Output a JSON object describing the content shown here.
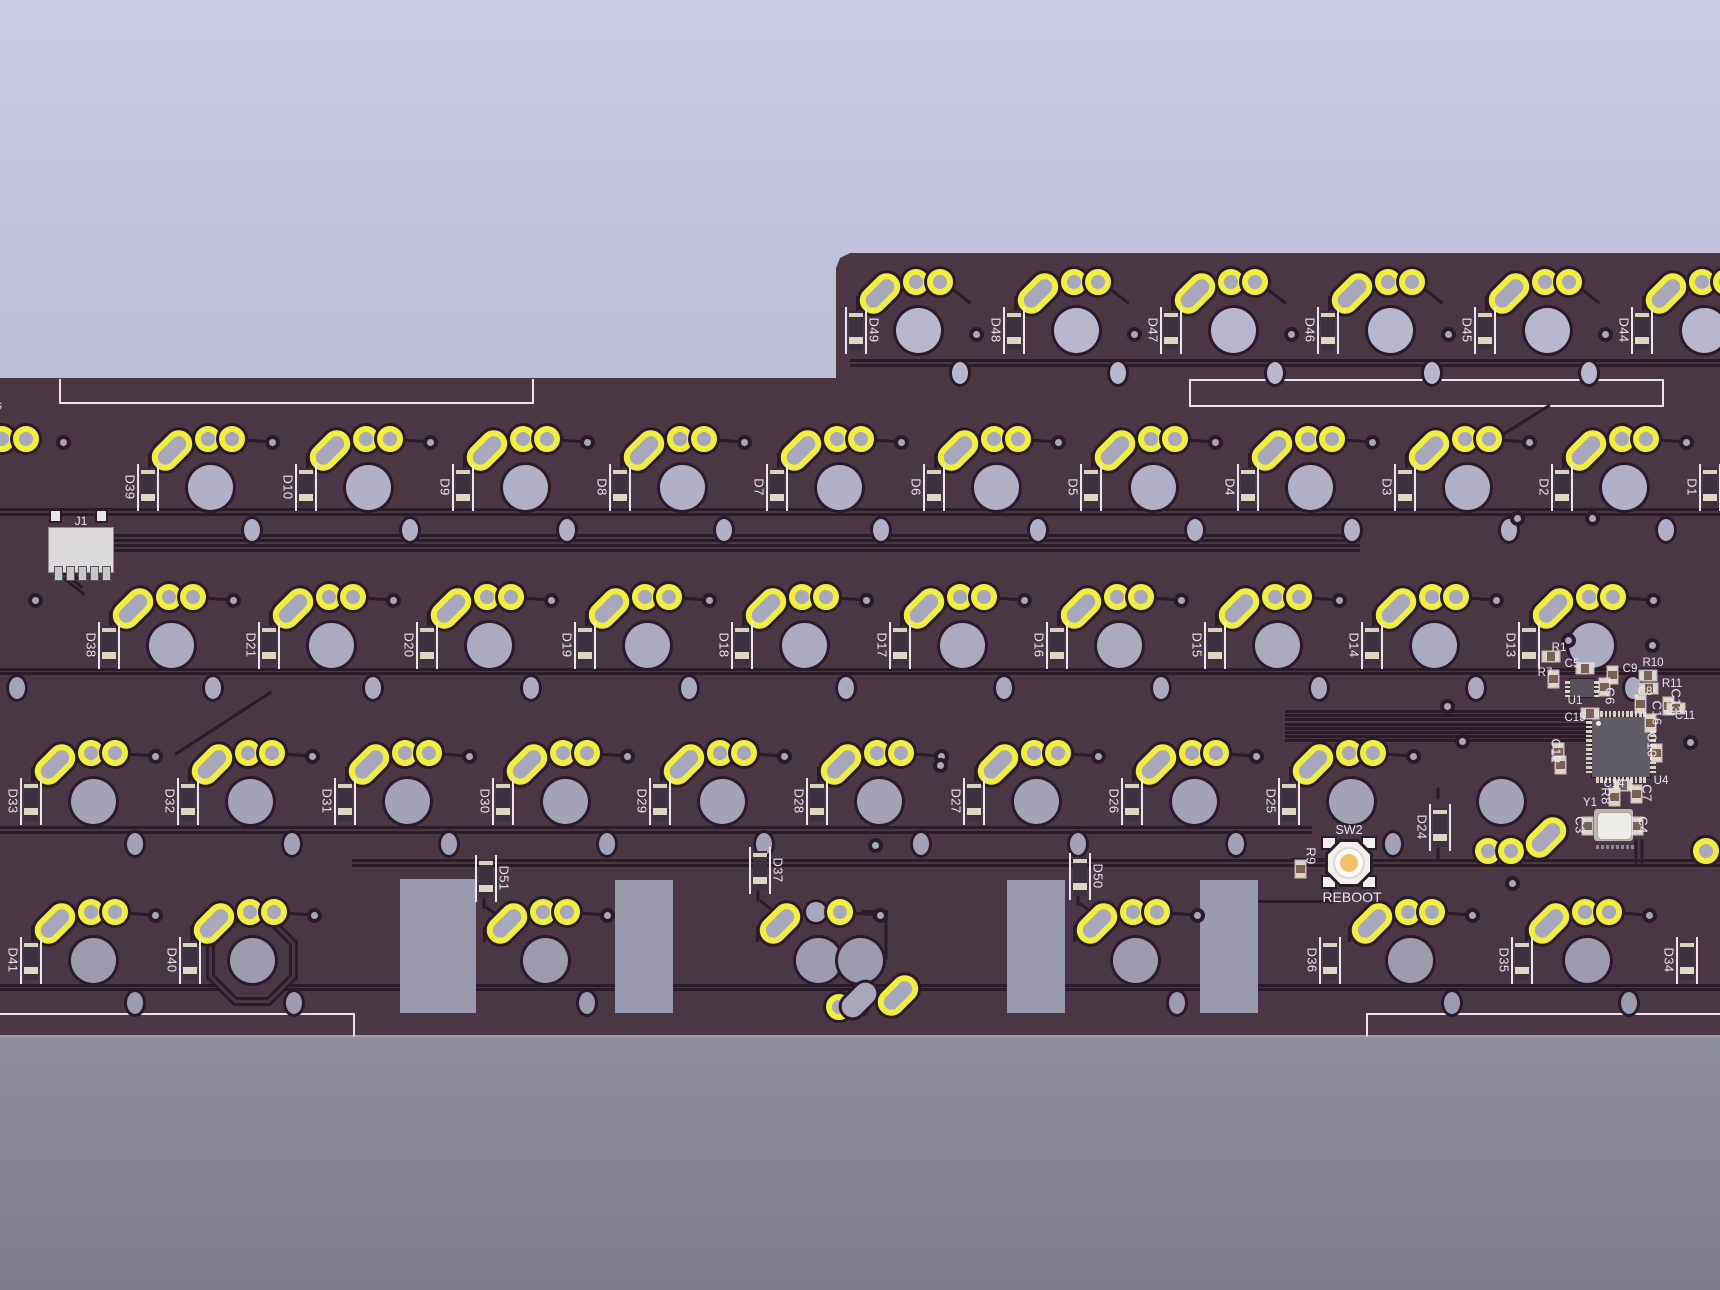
{
  "colors": {
    "board": "#4b3644",
    "trace": "#2b1b29",
    "pad_yellow": "#f2ee3f",
    "silkscreen": "#e6e4ea",
    "bg_top": "#cacae4",
    "bg_bottom": "#7e7c8a",
    "cutout": "#9a99af",
    "ic_body": "#605d66",
    "button_center": "#f1c369",
    "component_pad": "#ded7c6"
  },
  "silkscreen": {
    "left_edge_text": "s",
    "rect_left": {
      "x": 59,
      "y": 379,
      "w": 471,
      "h": 23
    },
    "rect_right": {
      "x": 1189,
      "y": 379,
      "w": 471,
      "h": 24
    },
    "bottom_left_line": {
      "x1": 0,
      "x2": 353,
      "y": 1013
    },
    "bottom_right_line": {
      "x1": 1366,
      "x2": 1720,
      "y": 1013
    }
  },
  "connector": {
    "label": "J1",
    "x": 48,
    "y": 527
  },
  "reboot": {
    "switch_label": "SW2",
    "button_label": "REBOOT",
    "x": 1349,
    "y": 862
  },
  "rows": [
    {
      "name": "row-function",
      "y": 330,
      "hole_color": "#b8b7cf",
      "via": [
        58,
        4
      ],
      "keys": [
        {
          "d": "D49",
          "x": 918,
          "side": "right"
        },
        {
          "d": "D48",
          "x": 1076
        },
        {
          "d": "D47",
          "x": 1233
        },
        {
          "d": "D46",
          "x": 1390
        },
        {
          "d": "D45",
          "x": 1547
        },
        {
          "d": "D44",
          "x": 1704
        }
      ]
    },
    {
      "name": "row-number",
      "y": 487,
      "hole_color": "#b1b0c8",
      "via": [
        62,
        -45
      ],
      "keys": [
        {
          "d": "D39",
          "x": 210
        },
        {
          "d": "D10",
          "x": 368
        },
        {
          "d": "D9",
          "x": 525
        },
        {
          "d": "D8",
          "x": 682
        },
        {
          "d": "D7",
          "x": 839
        },
        {
          "d": "D6",
          "x": 996
        },
        {
          "d": "D5",
          "x": 1153
        },
        {
          "d": "D4",
          "x": 1310
        },
        {
          "d": "D3",
          "x": 1467
        },
        {
          "d": "D2",
          "x": 1624
        }
      ]
    },
    {
      "name": "row-upper",
      "y": 645,
      "hole_color": "#abaac1",
      "via": [
        62,
        -45
      ],
      "keys": [
        {
          "d": "D38",
          "x": 171
        },
        {
          "d": "D21",
          "x": 331
        },
        {
          "d": "D20",
          "x": 489
        },
        {
          "d": "D19",
          "x": 647
        },
        {
          "d": "D18",
          "x": 804
        },
        {
          "d": "D17",
          "x": 962
        },
        {
          "d": "D16",
          "x": 1119
        },
        {
          "d": "D15",
          "x": 1277
        },
        {
          "d": "D14",
          "x": 1434
        },
        {
          "d": "D13",
          "x": 1591
        }
      ]
    },
    {
      "name": "row-home",
      "y": 801,
      "hole_color": "#a3a2b8",
      "via": [
        62,
        -45
      ],
      "keys": [
        {
          "d": "D33",
          "x": 93
        },
        {
          "d": "D32",
          "x": 250
        },
        {
          "d": "D31",
          "x": 407
        },
        {
          "d": "D30",
          "x": 565
        },
        {
          "d": "D29",
          "x": 722
        },
        {
          "d": "D28",
          "x": 879
        },
        {
          "d": "D27",
          "x": 1036
        },
        {
          "d": "D26",
          "x": 1194
        },
        {
          "d": "D25",
          "x": 1351
        },
        {
          "x": 1501,
          "no_diode": 1,
          "no_pads": 1
        }
      ]
    },
    {
      "name": "row-bottom",
      "y": 960,
      "hole_color": "#9c9bb1",
      "via": [
        62,
        -45
      ],
      "keys": [
        {
          "d": "D41",
          "x": 93
        },
        {
          "d": "D40",
          "x": 252,
          "octagon": 1
        },
        {
          "x": 545,
          "no_diode": 1
        },
        {
          "x": 818,
          "no_diode": 1,
          "pad1_plain": 1,
          "extra_hole": 42
        },
        {
          "x": 1135,
          "no_diode": 1
        },
        {
          "d": "D36",
          "x": 1410,
          "ddx": -80
        },
        {
          "d": "D35",
          "x": 1587,
          "ddx": -65
        }
      ]
    }
  ],
  "loose_diodes": [
    {
      "d": "D51",
      "x": 486,
      "y": 878,
      "side": "right"
    },
    {
      "d": "D37",
      "x": 760,
      "y": 870,
      "side": "right"
    },
    {
      "d": "D50",
      "x": 1080,
      "y": 876,
      "side": "right"
    },
    {
      "d": "D24",
      "x": 1440,
      "y": 827,
      "side": "left"
    },
    {
      "d": "D1",
      "x": 1710,
      "y": 487,
      "side": "left"
    },
    {
      "d": "D34",
      "x": 1687,
      "y": 960,
      "side": "left"
    }
  ],
  "cluster": {
    "u1": {
      "label": "U1",
      "x": 1570,
      "y": 679,
      "w": 24,
      "h": 18,
      "lx": 1575,
      "ly": 701
    },
    "u4": {
      "label": "U4",
      "x": 1592,
      "y": 717,
      "w": 58,
      "h": 60,
      "lx": 1661,
      "ly": 781
    },
    "y1": {
      "label": "Y1",
      "x": 1597,
      "y": 812,
      "w": 33,
      "h": 26,
      "lx": 1590,
      "ly": 803
    },
    "labels": [
      {
        "t": "R1",
        "x": 1559,
        "y": 648
      },
      {
        "t": "C5",
        "x": 1572,
        "y": 664
      },
      {
        "t": "R7",
        "x": 1545,
        "y": 673
      },
      {
        "t": "C9",
        "x": 1630,
        "y": 669
      },
      {
        "t": "C6",
        "x": 1610,
        "y": 696,
        "v": 1
      },
      {
        "t": "R10",
        "x": 1653,
        "y": 663
      },
      {
        "t": "R11",
        "x": 1672,
        "y": 684
      },
      {
        "t": "C8",
        "x": 1645,
        "y": 692
      },
      {
        "t": "C13",
        "x": 1676,
        "y": 701,
        "v": 1
      },
      {
        "t": "C16",
        "x": 1657,
        "y": 713,
        "v": 1
      },
      {
        "t": "C11",
        "x": 1685,
        "y": 716
      },
      {
        "t": "C15",
        "x": 1575,
        "y": 718
      },
      {
        "t": "C12",
        "x": 1556,
        "y": 751,
        "v": 1
      },
      {
        "t": "C10",
        "x": 1652,
        "y": 745,
        "v": 1
      },
      {
        "t": "C14",
        "x": 1614,
        "y": 784
      },
      {
        "t": "R8",
        "x": 1606,
        "y": 796,
        "v": 1
      },
      {
        "t": "C7",
        "x": 1647,
        "y": 793,
        "v": 1
      },
      {
        "t": "C3",
        "x": 1580,
        "y": 825,
        "v": 1
      },
      {
        "t": "C4",
        "x": 1643,
        "y": 825,
        "v": 1
      },
      {
        "t": "R9",
        "x": 1311,
        "y": 856,
        "v": 1
      }
    ],
    "components": [
      {
        "x": 1551,
        "y": 656
      },
      {
        "x": 1585,
        "y": 668
      },
      {
        "x": 1553,
        "y": 679,
        "v": 1
      },
      {
        "x": 1612,
        "y": 675,
        "v": 1
      },
      {
        "x": 1604,
        "y": 687,
        "v": 1
      },
      {
        "x": 1648,
        "y": 675
      },
      {
        "x": 1649,
        "y": 688
      },
      {
        "x": 1640,
        "y": 704,
        "v": 1
      },
      {
        "x": 1668,
        "y": 706,
        "v": 1
      },
      {
        "x": 1650,
        "y": 723,
        "v": 1
      },
      {
        "x": 1676,
        "y": 708
      },
      {
        "x": 1590,
        "y": 713
      },
      {
        "x": 1558,
        "y": 752,
        "v": 1
      },
      {
        "x": 1560,
        "y": 765,
        "v": 1
      },
      {
        "x": 1656,
        "y": 753,
        "v": 1
      },
      {
        "x": 1623,
        "y": 785
      },
      {
        "x": 1614,
        "y": 797,
        "v": 1
      },
      {
        "x": 1636,
        "y": 794,
        "v": 1
      },
      {
        "x": 1587,
        "y": 826,
        "v": 1
      },
      {
        "x": 1637,
        "y": 826,
        "v": 1
      },
      {
        "x": 1300,
        "y": 869,
        "v": 1
      }
    ],
    "dots_row": {
      "x": 1596,
      "y": 845,
      "n": 8,
      "dx": 5
    }
  },
  "extra_pads": [
    {
      "t": "pad",
      "x": 1488,
      "y": 851
    },
    {
      "t": "pad",
      "x": 1511,
      "y": 851
    },
    {
      "t": "peanut",
      "x": 1546,
      "y": 838
    },
    {
      "t": "pad",
      "x": 1706,
      "y": 851
    },
    {
      "t": "pad",
      "x": 839,
      "y": 1007
    },
    {
      "t": "peanut_plain",
      "x": 862,
      "y": 1003
    },
    {
      "t": "peanut",
      "x": 898,
      "y": 996
    },
    {
      "t": "pad",
      "x": 2,
      "y": 439
    },
    {
      "t": "pad",
      "x": 26,
      "y": 439
    },
    {
      "t": "oval",
      "x": 17,
      "y": 688
    }
  ],
  "extra_vias": [
    [
      63,
      442
    ],
    [
      35,
      600
    ],
    [
      940,
      765
    ],
    [
      875,
      845
    ],
    [
      1447,
      706
    ],
    [
      1462,
      741
    ],
    [
      1512,
      883
    ],
    [
      1568,
      640
    ],
    [
      1652,
      645
    ],
    [
      1690,
      742
    ],
    [
      1517,
      518
    ],
    [
      1592,
      518
    ]
  ],
  "cutouts": [
    [
      400,
      879,
      76,
      134
    ],
    [
      615,
      880,
      58,
      133
    ],
    [
      1007,
      880,
      58,
      133
    ],
    [
      1200,
      880,
      58,
      133
    ]
  ],
  "buses": [
    [
      850,
      359,
      870
    ],
    [
      850,
      364,
      870
    ],
    [
      0,
      508,
      1720
    ],
    [
      0,
      513,
      1720
    ],
    [
      0,
      668,
      1720
    ],
    [
      0,
      672,
      1720
    ],
    [
      0,
      826,
      1312
    ],
    [
      0,
      831,
      1312
    ],
    [
      352,
      859,
      1368
    ],
    [
      352,
      864,
      1368
    ],
    [
      0,
      984,
      1720
    ],
    [
      0,
      988,
      1720
    ],
    [
      85,
      534,
      1275
    ],
    [
      85,
      539,
      1275
    ],
    [
      85,
      544,
      1275
    ],
    [
      85,
      549,
      1275
    ],
    [
      1285,
      710,
      305
    ],
    [
      1285,
      714,
      305
    ],
    [
      1285,
      718,
      305
    ],
    [
      1285,
      723,
      305
    ],
    [
      1285,
      727,
      305
    ],
    [
      1285,
      731,
      305
    ],
    [
      1285,
      735,
      305
    ],
    [
      1285,
      739,
      305
    ]
  ],
  "traces": [
    [
      58,
      556,
      26,
      38
    ],
    [
      60,
      563,
      26,
      38
    ],
    [
      62,
      570,
      26,
      38
    ],
    [
      64,
      577,
      26,
      38
    ],
    [
      1237,
      900,
      95,
      0
    ],
    [
      1331,
      861,
      42,
      90
    ],
    [
      1292,
      858,
      40,
      0
    ],
    [
      1636,
      838,
      24,
      90
    ],
    [
      1642,
      838,
      24,
      90
    ],
    [
      886,
      914,
      44,
      90
    ],
    [
      862,
      910,
      26,
      0
    ],
    [
      175,
      753,
      115,
      -33
    ],
    [
      1482,
      446,
      80,
      -32
    ],
    [
      484,
      893,
      14,
      90
    ],
    [
      486,
      906,
      42,
      33
    ],
    [
      758,
      886,
      14,
      90
    ],
    [
      760,
      899,
      34,
      38
    ],
    [
      1078,
      890,
      14,
      90
    ],
    [
      1080,
      902,
      30,
      38
    ],
    [
      1438,
      846,
      12,
      90
    ],
    [
      1438,
      786,
      12,
      90
    ]
  ]
}
